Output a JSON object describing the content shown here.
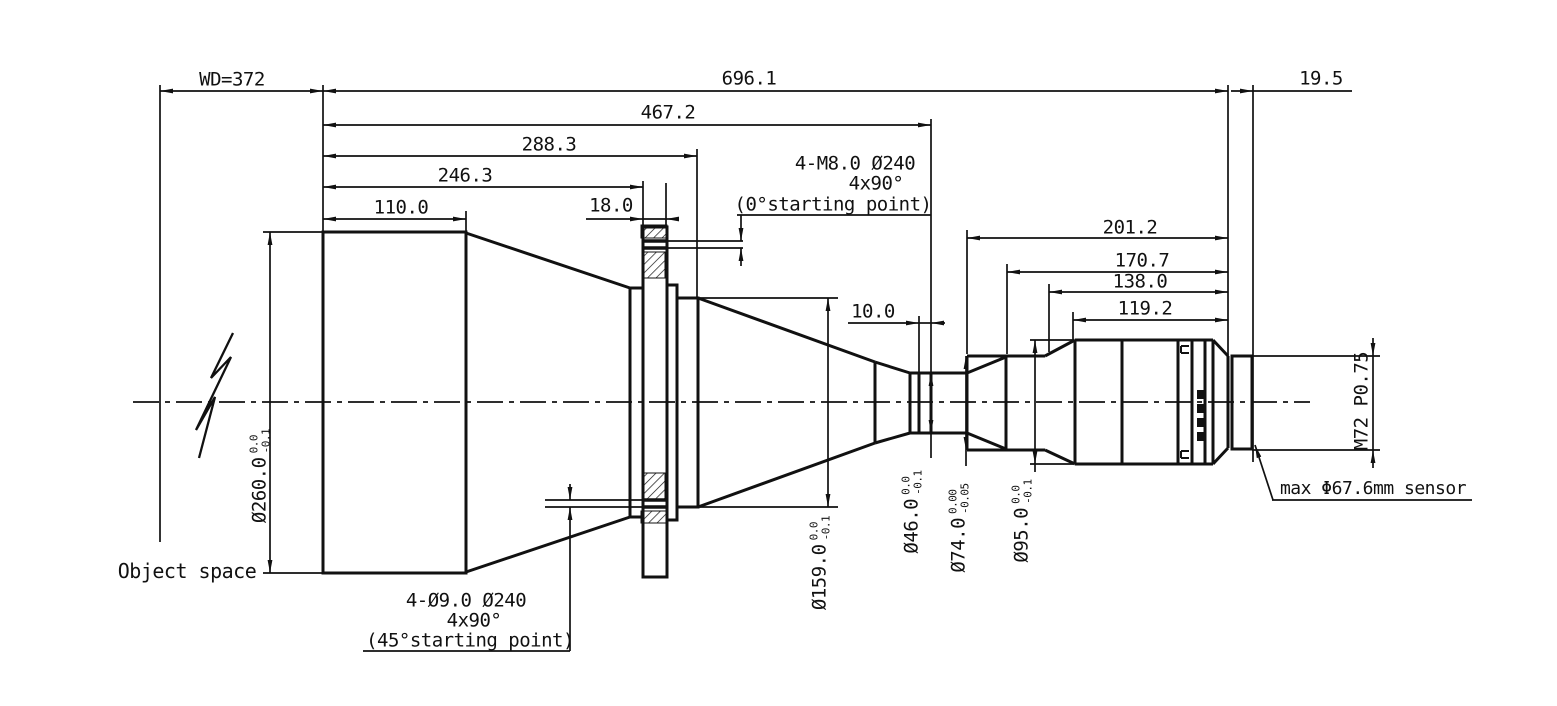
{
  "drawing": {
    "dimensions": {
      "wd": "WD=372",
      "total_length": "696.1",
      "back_focal": "19.5",
      "l467": "467.2",
      "l288": "288.3",
      "l246": "246.3",
      "l110": "110.0",
      "flange_thickness": "18.0",
      "r201": "201.2",
      "r170": "170.7",
      "r138": "138.0",
      "r119": "119.2",
      "groove_width": "10.0"
    },
    "diameters": {
      "d260": {
        "label": "Ø260.0",
        "tol_upper": "0.0",
        "tol_lower": "-0.1"
      },
      "d159": {
        "label": "Ø159.0",
        "tol_upper": "0.0",
        "tol_lower": "-0.1"
      },
      "d46": {
        "label": "Ø46.0",
        "tol_upper": "0.0",
        "tol_lower": "-0.1"
      },
      "d74": {
        "label": "Ø74.0",
        "tol_upper": "0.00",
        "tol_lower": "-0.05"
      },
      "d95": {
        "label": "Ø95.0",
        "tol_upper": "0.0",
        "tol_lower": "-0.1"
      }
    },
    "thread": "M72 P0.75",
    "notes": {
      "m8_line1": "4-M8.0 Ø240",
      "m8_line2": "4x90°",
      "m8_line3": "(0°starting point)",
      "p9_line1": "4-Ø9.0 Ø240",
      "p9_line2": "4x90°",
      "p9_line3": "(45°starting point)",
      "sensor": "max Φ67.6mm sensor",
      "object_space": "Object space"
    }
  }
}
